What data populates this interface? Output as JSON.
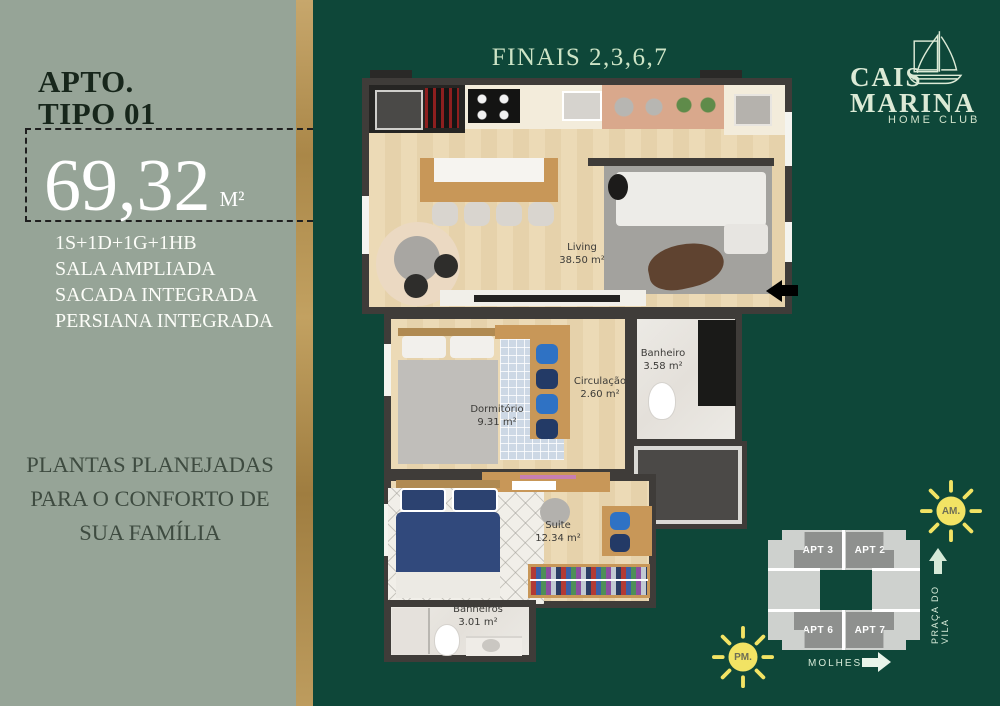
{
  "sidebar": {
    "title_line1": "APTO.",
    "title_line2": "TIPO 01",
    "area_value": "69,32",
    "area_unit": "M²",
    "features": [
      "1S+1D+1G+1HB",
      "SALA AMPLIADA",
      "SACADA INTEGRADA",
      "PERSIANA INTEGRADA"
    ],
    "tagline": "PLANTAS PLANEJADAS PARA O CONFORTO DE SUA FAMÍLIA"
  },
  "header": {
    "finais": "FINAIS 2,3,6,7"
  },
  "logo": {
    "line1": "CAIS",
    "line2": "MARINA",
    "line3": "HOME CLUB"
  },
  "floor_plan": {
    "rooms": [
      {
        "name": "Living",
        "area": "38.50 m²"
      },
      {
        "name": "Banheiro",
        "area": "3.58 m²"
      },
      {
        "name": "Circulação",
        "area": "2.60 m²"
      },
      {
        "name": "Dormitório",
        "area": "9.31 m²"
      },
      {
        "name": "Suite",
        "area": "12.34 m²"
      },
      {
        "name": "Banheiros",
        "area": "3.01 m²"
      }
    ]
  },
  "site_map": {
    "units": [
      "APT 3",
      "APT 2",
      "APT 6",
      "APT 7"
    ],
    "praca": "PRAÇA DO VILA",
    "molhes": "MOLHES",
    "am": "AM.",
    "pm": "PM."
  },
  "colors": {
    "background_green": "#0e4739",
    "sidebar_sage": "#96a497",
    "gold": "#b3914f",
    "pale_green_text": "#cde4c6",
    "sun_yellow": "#f2e364"
  }
}
